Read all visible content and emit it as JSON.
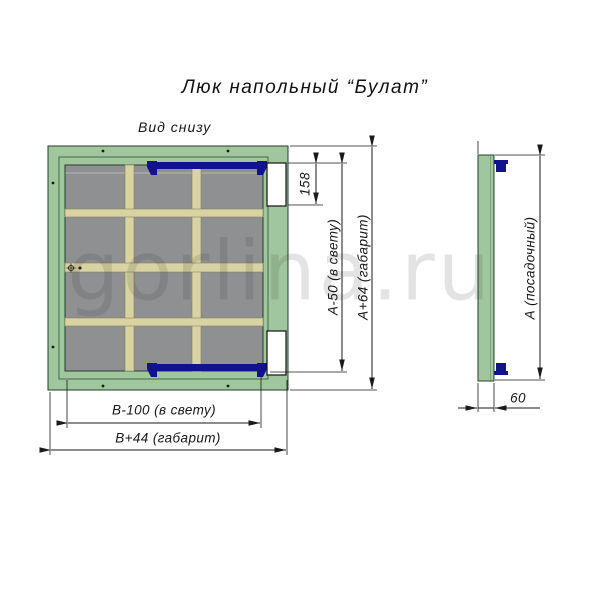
{
  "title": "Люк напольный “Булат”",
  "view_label": "Вид снизу",
  "watermark": "gorlina.ru",
  "dimensions": {
    "pocket_height": "158",
    "clear_height": "А-50 (в свету)",
    "overall_height": "А+64 (габарит)",
    "clear_width": "В-100 (в свету)",
    "overall_width": "В+44 (габарит)",
    "seat_size": "А (посадочный)",
    "thickness": "60"
  },
  "colors": {
    "green": "#9fc69c",
    "green_light": "#aecfa9",
    "panel_gray": "#8e9092",
    "rib_beige": "#d9d3a3",
    "rib_edge": "#84845a",
    "hinge_navy": "#12128c",
    "edge_dark": "#23402a",
    "ink": "#1a1a1a"
  }
}
